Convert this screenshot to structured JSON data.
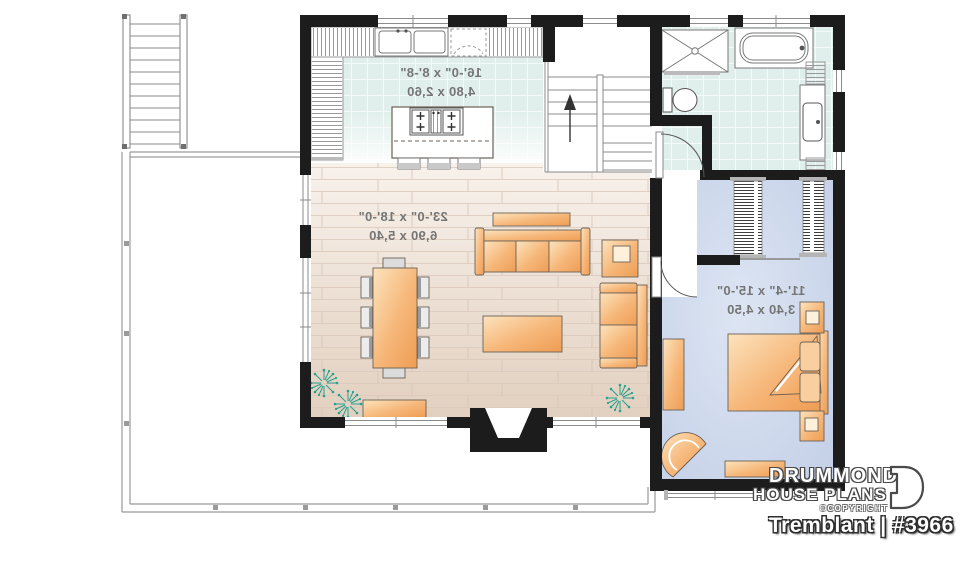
{
  "plan": {
    "rooms": [
      {
        "name": "kitchen",
        "imperial": "16'-0\" x 8'-8\"",
        "metric": "4,80 x 2,60"
      },
      {
        "name": "living-dining",
        "imperial": "23'-0\" x 18'-0\"",
        "metric": "6,90 x 5,40"
      },
      {
        "name": "bedroom",
        "imperial": "11'-4\" x 15'-0\"",
        "metric": "3,40 x 4,50"
      }
    ],
    "text_mirrored": true
  },
  "branding": {
    "brand_line1": "DRUMMOND",
    "brand_line2": "HOUSE PLANS",
    "copyright": "©COPYRIGHT",
    "plan_title": "Tremblant",
    "plan_number": "#3966",
    "title_text": "Tremblant | #3966"
  },
  "icons": {
    "up_arrow": "stairs-direction-up",
    "plant": "houseplant-symbol",
    "d_mark": "drummond-logo-mark"
  },
  "colors": {
    "wall": "#1c1c1c",
    "tile_floor": "#e0efeb",
    "wood_floor": "#ecdccd",
    "bedroom_floor": "#cbd6ea",
    "furniture_orange": "#f5b476",
    "plant_teal": "#27a18f",
    "thin_line": "#8b8b8b",
    "dimension_text": "#757575"
  }
}
